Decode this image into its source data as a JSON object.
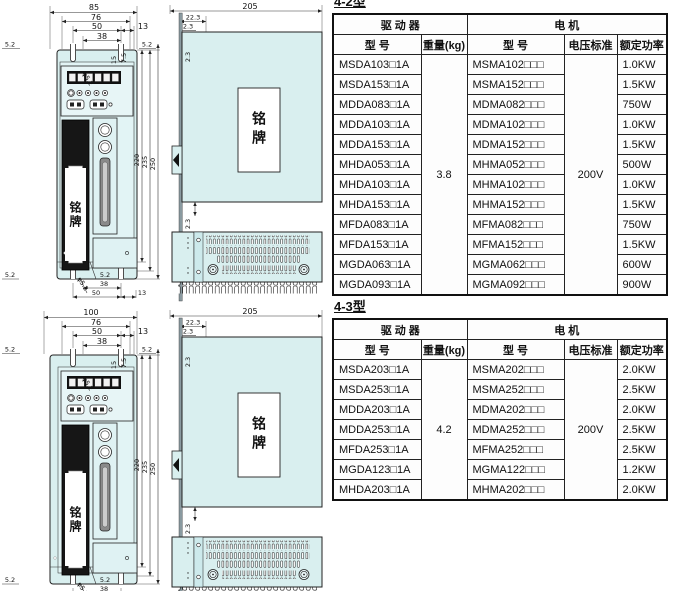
{
  "colors": {
    "body_fill": "#d9efef",
    "panel_fill": "#e2f4f5",
    "line": "#222222",
    "display_dark": "#101010"
  },
  "sections": [
    {
      "type_label": "4-2型",
      "front": {
        "overall": "85",
        "d76": "76",
        "d50": "50",
        "d38": "38",
        "d13": "13",
        "d52l": "5.2",
        "d52r": "5.2",
        "dhole": "φ5.2",
        "d15": "15",
        "d75": "7.5",
        "d220": "220",
        "d235": "235",
        "d250": "250",
        "b52l": "5.2",
        "b52r": "5.2",
        "bhole": "φ5.2",
        "b38": "38",
        "b50": "50",
        "b13": "13",
        "nameplate": "铭牌"
      },
      "side": {
        "d205": "205",
        "d223": "22.3",
        "d23top": "2.3",
        "d23upper": "2.3",
        "d23lower": "2.3",
        "nameplate": "铭牌"
      },
      "table": {
        "group_driver": "驱 动 器",
        "group_motor": "电  机",
        "col_model_driver": "型 号",
        "col_weight": "重量(kg)",
        "col_model_motor": "型 号",
        "col_voltage": "电压标准",
        "col_power": "额定功率",
        "weight": "3.8",
        "voltage": "200V",
        "rows": [
          {
            "driver": "MSDA103□1A",
            "motor": "MSMA102□□□",
            "power": "1.0KW"
          },
          {
            "driver": "MSDA153□1A",
            "motor": "MSMA152□□□",
            "power": "1.5KW"
          },
          {
            "driver": "MDDA083□1A",
            "motor": "MDMA082□□□",
            "power": "750W"
          },
          {
            "driver": "MDDA103□1A",
            "motor": "MDMA102□□□",
            "power": "1.0KW"
          },
          {
            "driver": "MDDA153□1A",
            "motor": "MDMA152□□□",
            "power": "1.5KW"
          },
          {
            "driver": "MHDA053□1A",
            "motor": "MHMA052□□□",
            "power": "500W"
          },
          {
            "driver": "MHDA103□1A",
            "motor": "MHMA102□□□",
            "power": "1.0KW"
          },
          {
            "driver": "MHDA153□1A",
            "motor": "MHMA152□□□",
            "power": "1.5KW"
          },
          {
            "driver": "MFDA083□1A",
            "motor": "MFMA082□□□",
            "power": "750W"
          },
          {
            "driver": "MFDA153□1A",
            "motor": "MFMA152□□□",
            "power": "1.5KW"
          },
          {
            "driver": "MGDA063□1A",
            "motor": "MGMA062□□□",
            "power": "600W"
          },
          {
            "driver": "MGDA093□1A",
            "motor": "MGMA092□□□",
            "power": "900W"
          }
        ]
      }
    },
    {
      "type_label": "4-3型",
      "front": {
        "overall": "100",
        "d76": "76",
        "d50": "50",
        "d38": "38",
        "d13": "13",
        "d52l": "5.2",
        "d52r": "5.2",
        "dhole": "φ5.2",
        "d15": "15",
        "d75": "7.5",
        "d220": "220",
        "d235": "235",
        "d250": "250",
        "b52l": "5.2",
        "b52r": "5.2",
        "bhole": "φ5.2",
        "b38": "38",
        "b50": "50",
        "b13": "13",
        "nameplate": "铭牌"
      },
      "side": {
        "d205": "205",
        "d223": "22.3",
        "d23top": "2.3",
        "d23upper": "2.3",
        "d23lower": "2.3",
        "nameplate": "铭牌"
      },
      "table": {
        "group_driver": "驱 动 器",
        "group_motor": "电  机",
        "col_model_driver": "型 号",
        "col_weight": "重量(kg)",
        "col_model_motor": "型 号",
        "col_voltage": "电压标准",
        "col_power": "额定功率",
        "weight": "4.2",
        "voltage": "200V",
        "rows": [
          {
            "driver": "MSDA203□1A",
            "motor": "MSMA202□□□",
            "power": "2.0KW"
          },
          {
            "driver": "MSDA253□1A",
            "motor": "MSMA252□□□",
            "power": "2.5KW"
          },
          {
            "driver": "MDDA203□1A",
            "motor": "MDMA202□□□",
            "power": "2.0KW"
          },
          {
            "driver": "MDDA253□1A",
            "motor": "MDMA252□□□",
            "power": "2.5KW"
          },
          {
            "driver": "MFDA253□1A",
            "motor": "MFMA252□□□",
            "power": "2.5KW"
          },
          {
            "driver": "MGDA123□1A",
            "motor": "MGMA122□□□",
            "power": "1.2KW"
          },
          {
            "driver": "MHDA203□1A",
            "motor": "MHMA202□□□",
            "power": "2.0KW"
          }
        ]
      }
    }
  ]
}
